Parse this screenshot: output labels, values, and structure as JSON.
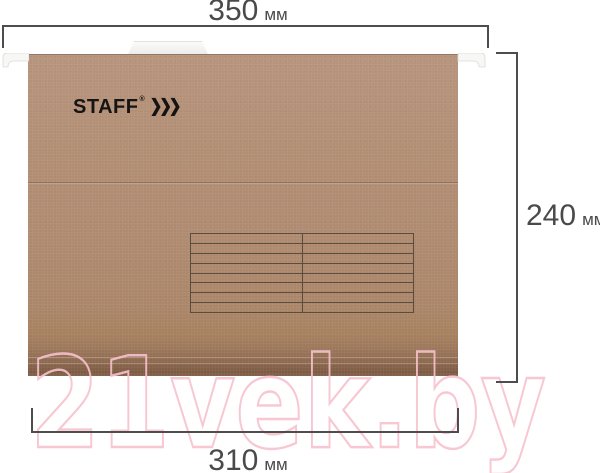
{
  "title": "Hanging file folder dimension diagram",
  "dimensions": {
    "top": {
      "value": "350",
      "unit": "мм"
    },
    "right": {
      "value": "240",
      "unit": "мм"
    },
    "bottom": {
      "value": "310",
      "unit": "мм"
    }
  },
  "folder": {
    "brand": "STAFF",
    "brand_mark": "®",
    "chevrons": "❯❯❯",
    "label_table": {
      "rows": 8,
      "columns": 2
    }
  },
  "watermark": {
    "text": "21vek.by"
  },
  "colors": {
    "dimension_line": "#4d4d4d",
    "dimension_text": "#4a4a4a",
    "folder_kraft": "#b18d73",
    "folder_edge_dark": "#7c5a43",
    "table_line": "#5a4c3f",
    "rail_white": "#f7f7f5",
    "watermark_pink": "#f7c2ce",
    "brand_black": "#161412"
  }
}
